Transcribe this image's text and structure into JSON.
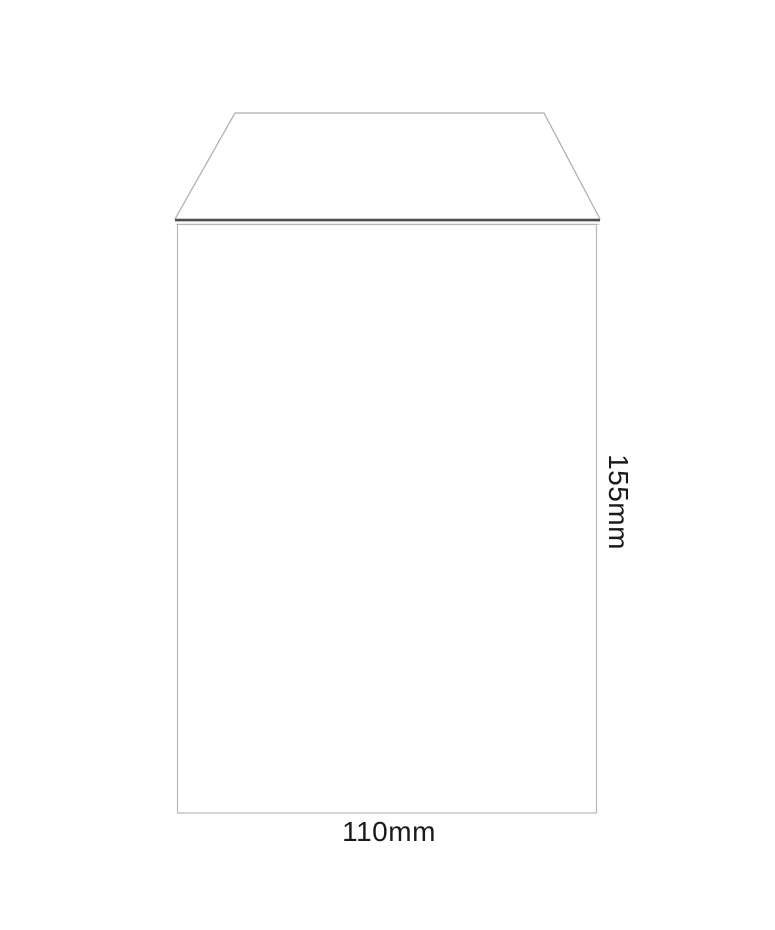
{
  "diagram": {
    "type": "envelope-dimension-diagram",
    "width_label": "110mm",
    "height_label": "155mm",
    "width_mm": 110,
    "height_mm": 155,
    "colors": {
      "background": "#ffffff",
      "body_outline": "#b5b8ba",
      "flap_outline": "#a9acae",
      "seal_line": "#4f4f4f",
      "body_top_edge": "#c3c6c8",
      "label_text": "#1a1a1a"
    }
  }
}
